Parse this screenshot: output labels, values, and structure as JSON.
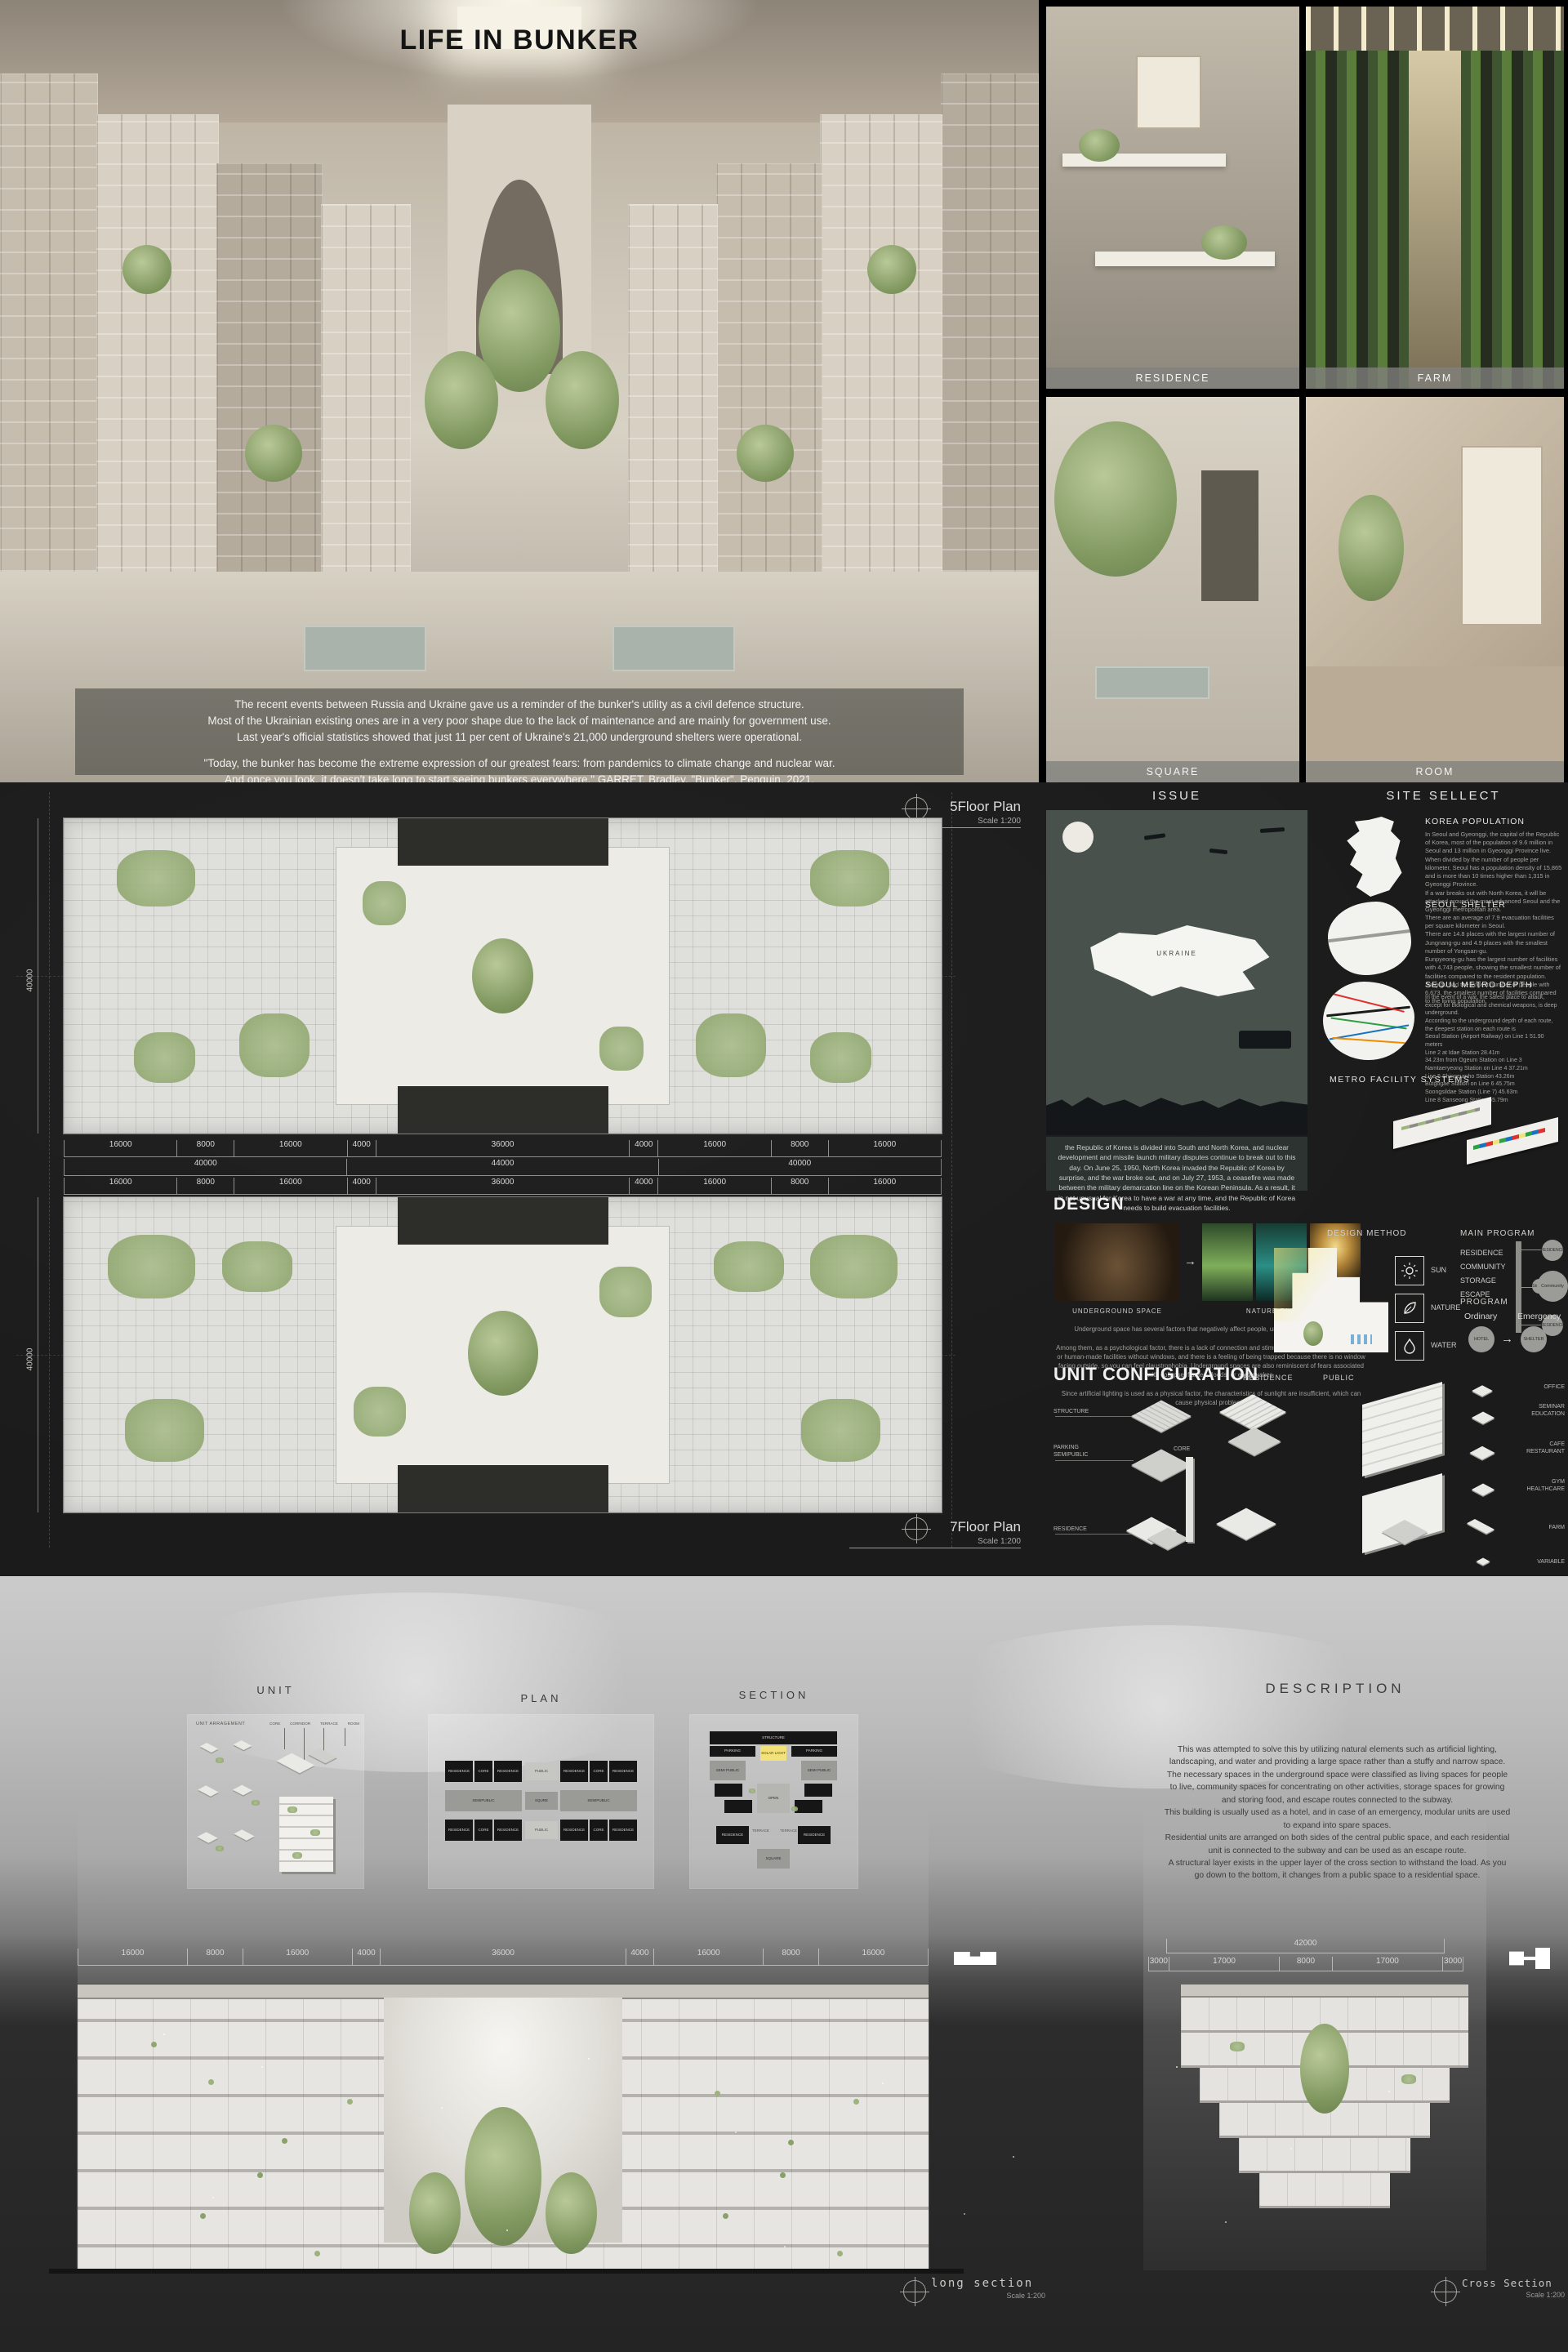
{
  "hero": {
    "title": "LIFE IN BUNKER",
    "intro_line1": "The recent events between Russia and Ukraine gave us a reminder of the bunker's utility as a civil defence structure.",
    "intro_line2": "Most of the Ukrainian existing ones are in a very poor shape due to the lack of maintenance and are mainly for government use.",
    "intro_line3": "Last year's official statistics showed that just 11 per cent of Ukraine's 21,000 underground shelters were operational.",
    "quote_line1": "\"Today, the bunker has become the extreme expression of our greatest fears: from pandemics to climate change and nuclear war.",
    "quote_line2": "And once you look, it doesn't take long to start seeing bunkers everywhere.\" GARRET, Bradley, \"Bunker\", Penguin, 2021."
  },
  "gallery": {
    "residence": "RESIDENCE",
    "farm": "FARM",
    "square": "SQUARE",
    "room": "ROOM"
  },
  "plans": {
    "plan1_title": "5Floor Plan",
    "plan2_title": "7Floor Plan",
    "scale": "Scale 1:200",
    "dims_row1": [
      "16000",
      "8000",
      "16000",
      "4000",
      "36000",
      "4000",
      "16000",
      "8000",
      "16000"
    ],
    "dims_row2": [
      "40000",
      "44000",
      "40000"
    ],
    "dims_row3": [
      "16000",
      "8000",
      "16000",
      "4000",
      "36000",
      "4000",
      "16000",
      "8000",
      "16000"
    ],
    "left_dim1": "40000",
    "left_dim2": "40000"
  },
  "issue": {
    "header": "ISSUE",
    "map_label": "UKRAINE",
    "caption": "the Republic of Korea is divided into South and North Korea, and nuclear development and missile launch military disputes continue to break out to this day. On June 25, 1950, North Korea invaded the Republic of Korea by surprise, and the war broke out, and on July 27, 1953, a ceasefire was made between the military demarcation line on the Korean Peninsula. As a result, it is not unusual for Korea to have a war at any time, and the Republic of Korea needs to build evacuation facilities."
  },
  "site": {
    "header": "SITE SELLECT",
    "sections": [
      {
        "title": "KOREA POPULATION",
        "body": "In Seoul and Gyeonggi, the capital of the Republic of Korea, most of the population of 9.6 million in Seoul and 13 million in Gyeonggi Province live.\nWhen divided by the number of people per kilometer, Seoul has a population density of 15,865 and is more than 10 times higher than 1,315 in Gyeonggi Province.\nIf a war breaks out with North Korea, it will be attacked around the most advanced Seoul and the Gyeonggi metropolitan area."
      },
      {
        "title": "SEOUL SHELTER",
        "body": "There are an average of 7.9 evacuation facilities per square kilometer in Seoul.\nThere are 14.8 places with the largest number of Jungnang-gu and 4.9 places with the smallest number of Yongsan-gu.\nEunpyeong-gu has the largest number of facilities with 4,743 people, showing the smallest number of facilities compared to the resident population.\nJung-gu had the largest number of people with 6,673, the smallest number of facilities compared to the living population."
      },
      {
        "title": "SEOUL METRO DEPTH",
        "body": "In the event of a war, the safest place to attack, except for biological and chemical weapons, is deep underground.\nAccording to the underground depth of each route, the deepest station on each route is\nSeoul Station (Airport Railway) on Line 1 51.90 meters\nLine 2 at Idae Station 28.41m\n34.23m from Ogeum Station on Line 3\nNamtaeryeong Station on Line 4 37.21m\nLine 5 Shingeumho Station 43.26m\nButgogae Station on Line 6 45.75m\nSoongsildae Station (Line 7) 45.63m\nLine 8 Sanseong Station 55.79m"
      }
    ],
    "metro_label": "METRO FACILITY SYSTEMS"
  },
  "design": {
    "header": "DESIGN",
    "underground_label": "UNDERGROUND SPACE",
    "nature_label": "NATURE FACTORS",
    "body": "Underground space has several factors that negatively affect people, unlike space on the ground.\n\nAmong them, as a psychological factor, there is a lack of connection and stimulation with nature on the ground or human-made facilities without windows, and there is a feeling of being trapped because there is no window facing outside, so you can feel claustrophobia. Underground spaces are also reminiscent of fears associated with collapse, flames, floods, or earthquakes.\n\nSince artificial lighting is used as a physical factor, the characteristics of sunlight are insufficient, which can cause physical problems.",
    "method_title": "DESIGN METHOD",
    "factors": [
      "SUN",
      "NATURE",
      "WATER"
    ],
    "main_program_title": "MAIN PROGRAM",
    "main_program_items": [
      "RESIDENCE",
      "COMMUNITY",
      "STORAGE",
      "ESCAPE"
    ],
    "bubbles": {
      "top": "RESIDENCE",
      "mid": "Community",
      "small": "Storage",
      "bottom": "RESIDENCE",
      "bar": "METRO"
    },
    "program_title": "PROGRAM",
    "ordinary": "Ordinary",
    "emergency": "Emergency",
    "hotel": "HOTEL",
    "shelter": "SHELTER"
  },
  "unit_config": {
    "header": "UNIT CONFIGURATION",
    "sub_residence": "RESIDENCE",
    "sub_public": "PUBLIC",
    "left_labels": [
      "STRUCTURE",
      "PARKING\nSEMIPUBLIC",
      "RESIDENCE"
    ],
    "core_label": "CORE",
    "right_labels": [
      "OFFICE",
      "SEMINAR\nEDUCATION",
      "CAFE\nRESTAURANT",
      "GYM\nHEALTHCARE",
      "FARM",
      "VARIABLE"
    ]
  },
  "bottom": {
    "unit_title": "UNIT",
    "unit_arrangement": "UNIT ARRAGEMENT",
    "unit_top_labels": [
      "CORE",
      "CORRIDOR",
      "TERRACE",
      "ROOM"
    ],
    "plan_title": "PLAN",
    "plan_labels": {
      "residence": "RESIDENCE",
      "core": "CORE",
      "semipublic": "SEMIPUBLIC",
      "public": "PUBLIC",
      "squre": "SQURE"
    },
    "section_title": "SECTION",
    "section_labels": {
      "structure": "STRUCTURE",
      "parking": "PARKING",
      "solar": "SOLAR LIGHT",
      "semipublic": "SEMI PUBLIC",
      "open": "OPEN",
      "terrace": "TERRACE",
      "residence": "RESIDENCE",
      "square": "SQUARE"
    },
    "description_title": "DESCRIPTION",
    "description_body": "This was attempted to solve this by utilizing natural elements such as artificial lighting, landscaping, and water and providing a large space rather than a stuffy and narrow space.\nThe necessary spaces in the underground space were classified as living spaces for people to live, community spaces for concentrating on other activities, storage spaces for growing and storing food, and escape routes connected to the subway.\nThis building is usually used as a hotel, and in case of an emergency, modular units are used to expand into spare spaces.\nResidential units are arranged on both sides of the central public space, and each residential unit is connected to the subway and can be used as an escape route.\nA structural layer exists in the upper layer of the cross section to withstand the load. As you go down to the bottom, it changes from a public space to a residential space.",
    "long_section": {
      "title": "long section",
      "scale": "Scale 1:200",
      "dims": [
        "16000",
        "8000",
        "16000",
        "4000",
        "36000",
        "4000",
        "16000",
        "8000",
        "16000"
      ]
    },
    "cross_section": {
      "title": "Cross Section",
      "scale": "Scale 1:200",
      "dim_total": "42000",
      "dims": [
        "3000",
        "17000",
        "8000",
        "17000",
        "3000"
      ]
    }
  }
}
